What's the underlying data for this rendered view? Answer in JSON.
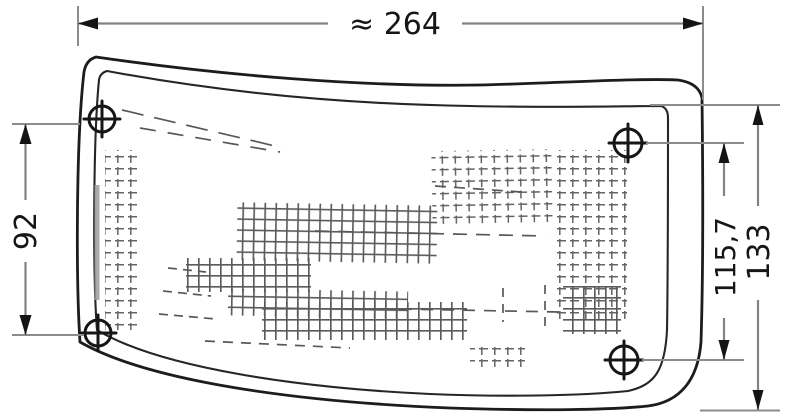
{
  "drawing": {
    "dimensions": {
      "overall_width": "≈ 264",
      "mount_height_left": "92",
      "mount_height_right": "115,7",
      "overall_height_right": "133"
    },
    "colors": {
      "object_line": "#1c1c1c",
      "dimension_line": "#838383",
      "arrow": "#141414",
      "background": "#ffffff"
    }
  }
}
